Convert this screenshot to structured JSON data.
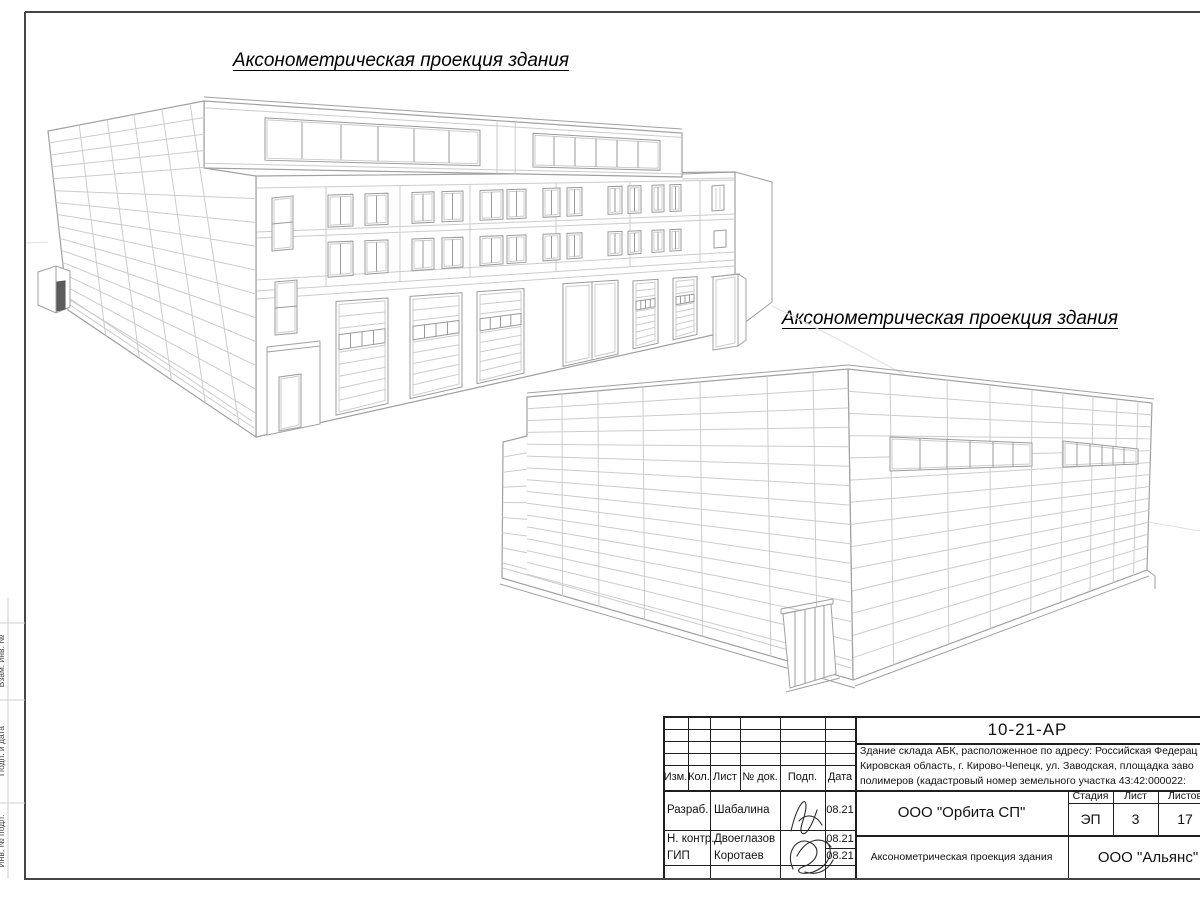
{
  "sheet": {
    "projection_title": "Аксонометрическая проекция здания",
    "margin_labels": [
      "Взам. инв. №",
      "Подп. и дата",
      "Инв. № подл."
    ],
    "stamp": {
      "doc_number": "10-21-АР",
      "description_lines": [
        "Здание склада АБК, расположенное по адресу: Российская Федерац",
        "Кировская область, г. Кирово-Чепецк, ул. Заводская, площадка заво",
        "полимеров (кадастровый номер земельного участка 43:42:000022:"
      ],
      "columns": {
        "izm": "Изм.",
        "kol": "Кол.",
        "list": "Лист",
        "ndok": "№ док.",
        "podp": "Подп.",
        "data": "Дата"
      },
      "rows": [
        {
          "role": "Разраб.",
          "name": "Шабалина",
          "date": "08.21"
        },
        {
          "role": "Н. контр.",
          "name": "Двоеглазов",
          "date": "08.21"
        },
        {
          "role": "ГИП",
          "name": "Коротаев",
          "date": "08.21"
        }
      ],
      "org": "ООО \"Орбита СП\"",
      "stage_label": "Стадия",
      "sheet_label": "Лист",
      "sheets_label": "Листов",
      "stage": "ЭП",
      "sheet_number": "3",
      "sheets_total": "17",
      "drawing_title": "Аксонометрическая проекция здания",
      "company": "ООО \"Альянс\""
    }
  }
}
